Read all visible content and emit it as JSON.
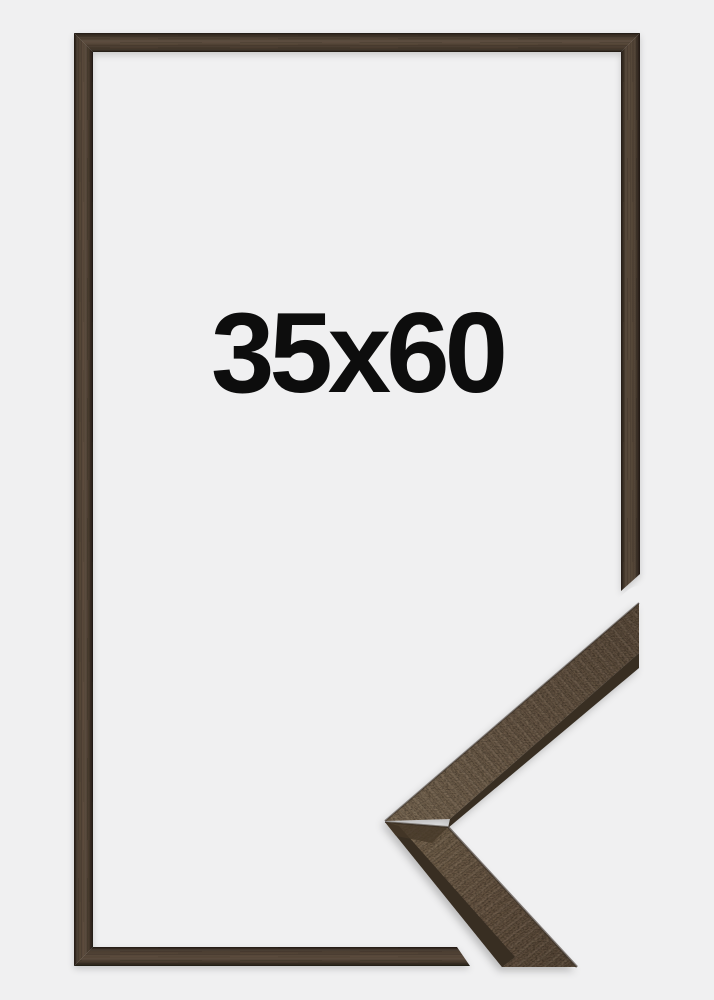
{
  "page": {
    "background_color": "#f0f0f1",
    "description_label": "Picture frame product preview"
  },
  "frame_preview": {
    "size_label": "35x60",
    "label_color": "#0d0d0d",
    "wood_edge_color": "#27201a",
    "wood_mid_color": "#5b4b3c"
  },
  "corner_sample": {
    "face_light_color": "#7b6a55",
    "face_dark_color": "#5e4e3e",
    "edge_dark_color": "#372e24"
  }
}
